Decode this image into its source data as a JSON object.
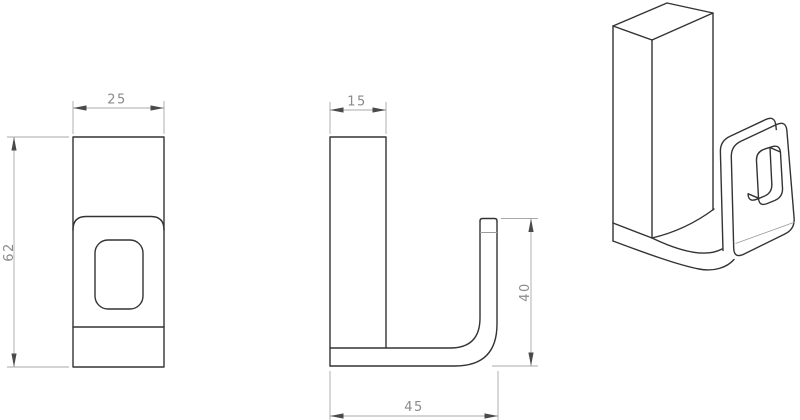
{
  "colors": {
    "background": "#ffffff",
    "part_outline": "#333333",
    "dimension_lines": "#a8a8a8",
    "dimension_text": "#8a8a8a",
    "arrowheads": "#4a4a4a"
  },
  "dimensions": {
    "front_width": "25",
    "front_height": "62",
    "side_top_width": "15",
    "side_hook_height": "40",
    "side_bottom_depth": "45"
  }
}
